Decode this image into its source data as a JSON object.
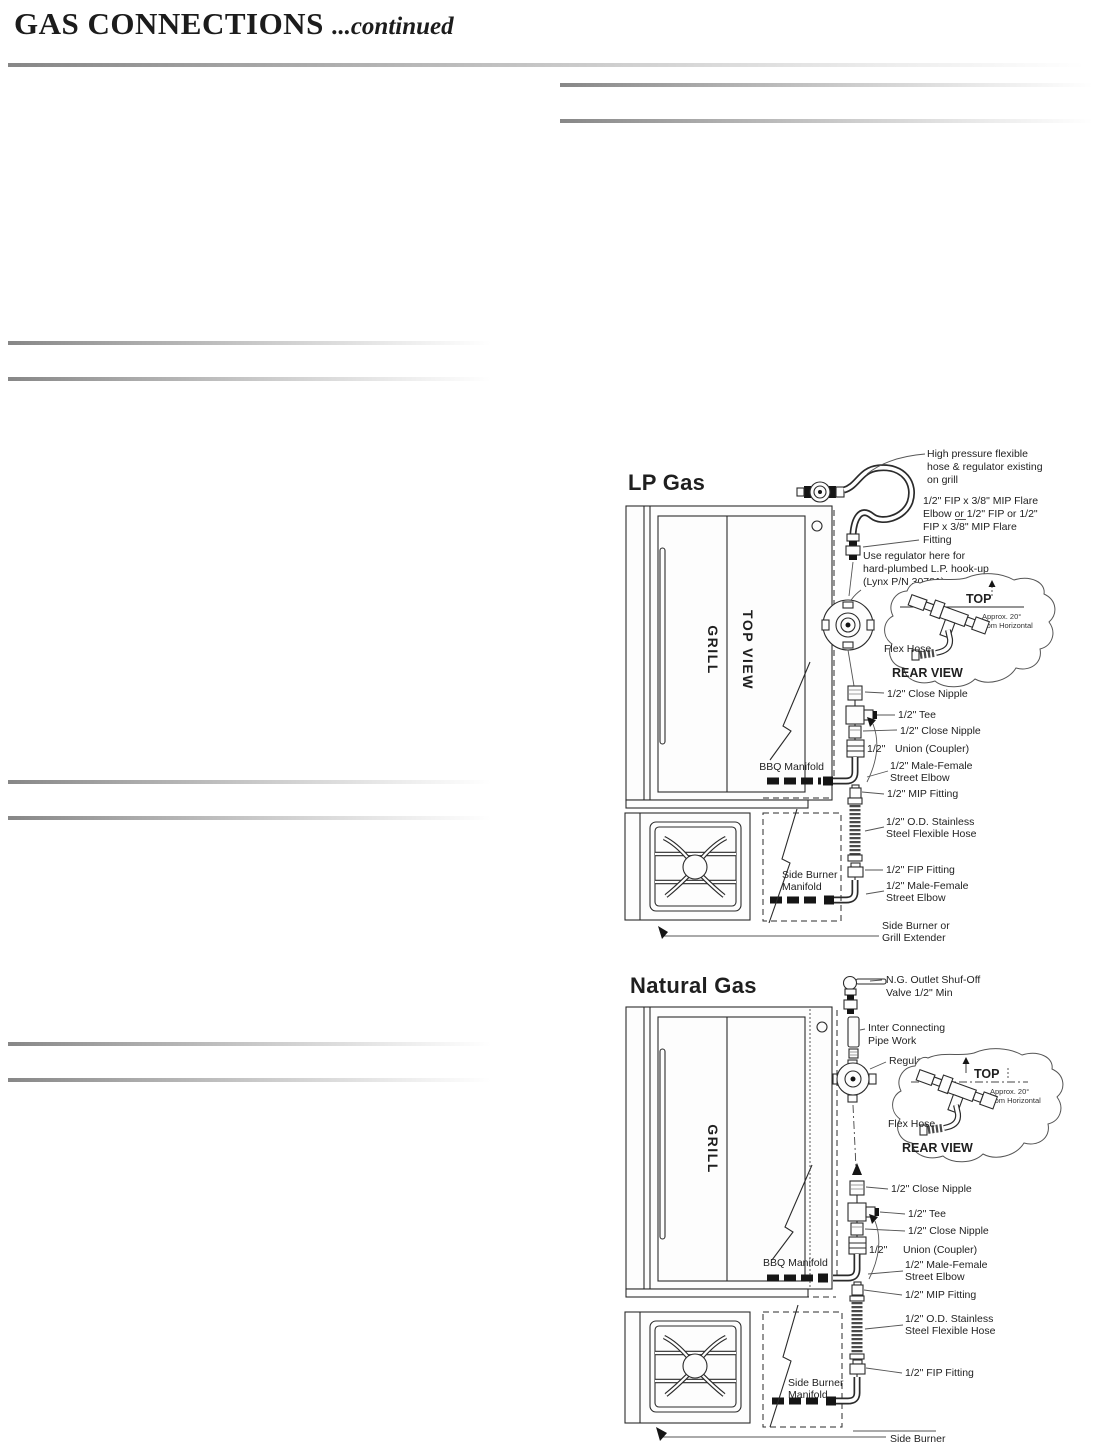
{
  "header": {
    "title": "GAS CONNECTIONS",
    "continued": "...continued"
  },
  "colors": {
    "ink": "#1c1c1c",
    "rule_gray": "#878787"
  },
  "lp": {
    "heading": "LP Gas",
    "grill": "GRILL",
    "top_view": "TOP VIEW",
    "high_pressure_1": "High pressure flexible",
    "high_pressure_2": "hose & regulator existing",
    "high_pressure_3": "on grill",
    "flare_1": "1/2\" FIP x 3/8\" MIP Flare",
    "flare_2": "Elbow or 1/2\" FIP or 1/2\"",
    "flare_3": "FIP x 3/8\" MIP Flare",
    "flare_4": "Fitting",
    "use_regulator_1": "Use regulator here for",
    "use_regulator_2": "hard-plumbed L.P. hook-up",
    "use_regulator_3": "(Lynx P/N 30781)",
    "inset": {
      "top": "TOP",
      "approx_1": "Approx. 20°",
      "approx_2": "from Horizontal",
      "flex_hose": "Flex Hose",
      "rear_view": "REAR VIEW"
    },
    "close_nipple_1": "1/2\" Close Nipple",
    "tee": "1/2\" Tee",
    "close_nipple_2": "1/2\" Close Nipple",
    "union_size": "1/2\"",
    "union_label": "Union (Coupler)",
    "male_female_1a": "1/2\" Male-Female",
    "male_female_1b": "Street Elbow",
    "mip_fitting": "1/2\" MIP Fitting",
    "ss_hose_1": "1/2\" O.D. Stainless",
    "ss_hose_2": "Steel Flexible Hose",
    "fip_fitting": "1/2\" FIP Fitting",
    "male_female_2a": "1/2\" Male-Female",
    "male_female_2b": "Street Elbow",
    "bbq_manifold": "BBQ Manifold",
    "sb_manifold_1": "Side Burner",
    "sb_manifold_2": "Manifold",
    "side_burner_1": "Side Burner or",
    "side_burner_2": "Grill Extender"
  },
  "ng": {
    "heading": "Natural Gas",
    "grill": "GRILL",
    "valve_1": "N.G. Outlet Shuf-Off",
    "valve_2": "Valve 1/2\" Min",
    "pipe_work_1": "Inter Connecting",
    "pipe_work_2": "Pipe Work",
    "regulator": "Regulator",
    "inset": {
      "top": "TOP",
      "approx_1": "Approx. 20°",
      "approx_2": "from Horizontal",
      "flex_hose": "Flex Hose",
      "rear_view": "REAR VIEW"
    },
    "close_nipple_1": "1/2\" Close Nipple",
    "tee": "1/2\" Tee",
    "close_nipple_2": "1/2\" Close Nipple",
    "union_size": "1/2\"",
    "union_label": "Union (Coupler)",
    "male_female_1a": "1/2\" Male-Female",
    "male_female_1b": "Street Elbow",
    "mip_fitting": "1/2\" MIP Fitting",
    "ss_hose_1": "1/2\" O.D. Stainless",
    "ss_hose_2": "Steel Flexible Hose",
    "fip_fitting": "1/2\" FIP Fitting",
    "bbq_manifold": "BBQ Manifold",
    "sb_manifold_1": "Side Burner",
    "sb_manifold_2": "Manifold",
    "side_burner": "Side Burner"
  }
}
